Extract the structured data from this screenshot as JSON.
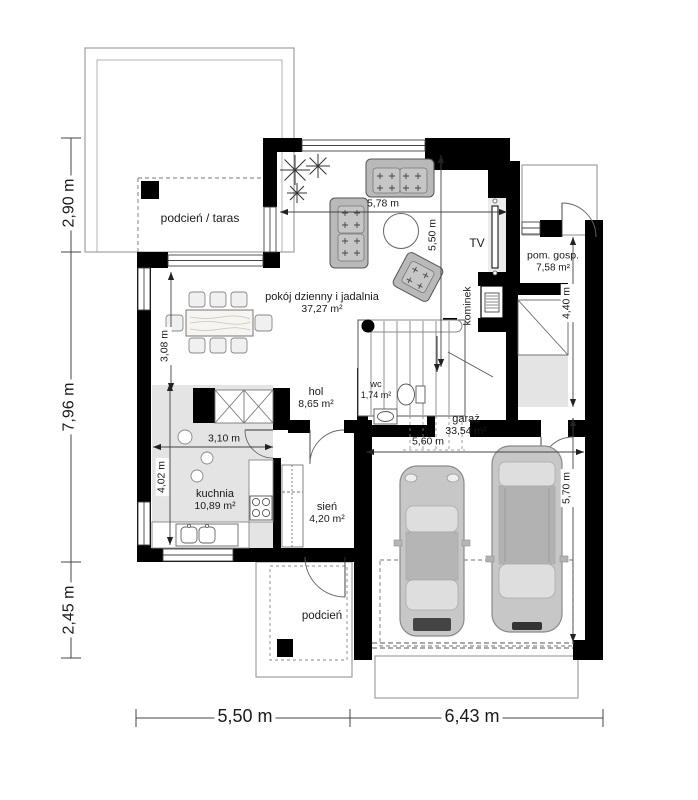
{
  "title": "Rzut parteru — plan domu",
  "colors": {
    "wall": "#000000",
    "room_shade": "#e4e4e4",
    "furniture_gray": "#bdbdbd",
    "outline_gray": "#a0a0a0",
    "dimension_line": "#444444"
  },
  "rooms": {
    "terrace": {
      "label": "podcień / taras"
    },
    "living": {
      "label": "pokój dzienny i jadalnia",
      "area": "37,27 m²"
    },
    "hall": {
      "label": "hol",
      "area": "8,65 m²"
    },
    "wc": {
      "label": "wc",
      "area": "1,74 m²"
    },
    "kitchen": {
      "label": "kuchnia",
      "area": "10,89 m²"
    },
    "vestibule": {
      "label": "sień",
      "area": "4,20 m²"
    },
    "garage": {
      "label": "garaż",
      "area": "33,54 m²"
    },
    "utility": {
      "label": "pom. gosp.",
      "area": "7,58 m²"
    },
    "porch": {
      "label": "podcień"
    }
  },
  "features": {
    "fireplace": "kominek",
    "tv": "TV"
  },
  "dimensions": {
    "exterior": {
      "left_top": "2,90 m",
      "left_middle": "7,96 m",
      "left_bottom": "2,45 m",
      "bottom_left": "5,50 m",
      "bottom_right": "6,43 m"
    },
    "interior": {
      "living_width": "5,78 m",
      "living_depth": "5,50 m",
      "dining_depth": "3,08 m",
      "kitchen_width": "3,10 m",
      "kitchen_depth": "4,02 m",
      "garage_width": "5,60 m",
      "garage_depth": "5,70 m",
      "utility_depth": "4,40 m"
    }
  }
}
